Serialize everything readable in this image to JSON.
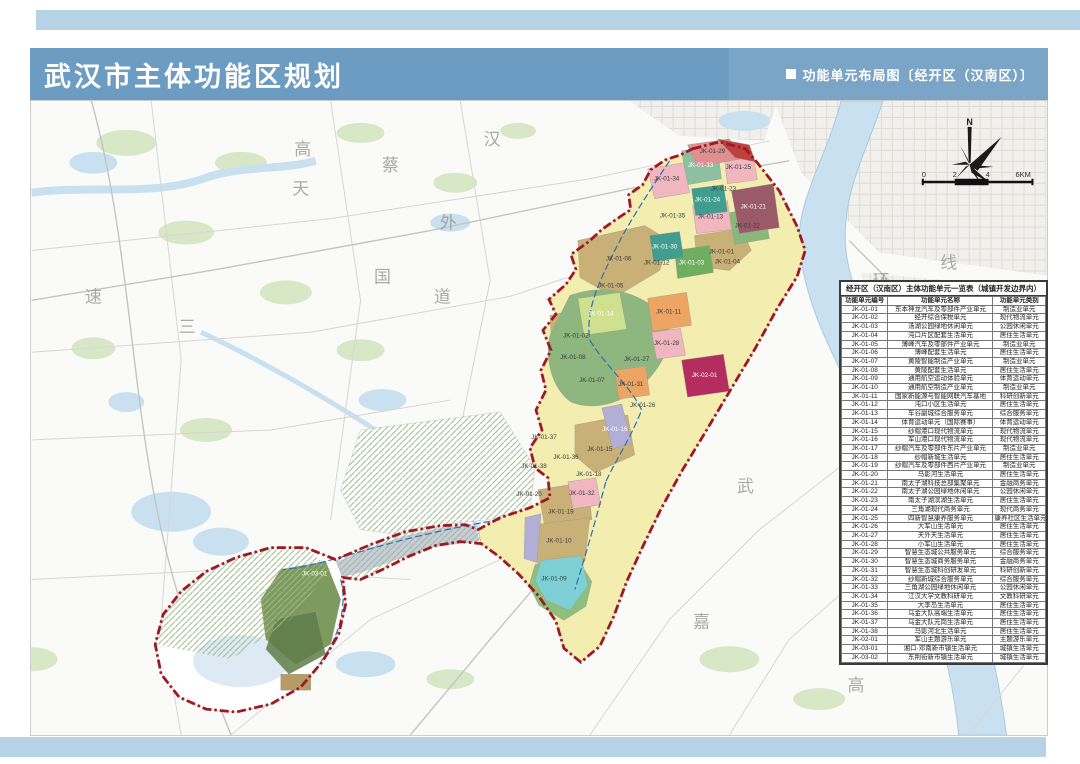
{
  "header": {
    "title": "武汉市主体功能区规划",
    "subtitle_marker": "■",
    "subtitle": "功能单元布局图〔经开区（汉南区）〕"
  },
  "compass": {
    "north_label": "N"
  },
  "scalebar": {
    "labels": [
      "0",
      "2",
      "4",
      "6KM"
    ]
  },
  "table": {
    "title": "经开区（汉南区）主体功能单元一览表（城镇开发边界内）",
    "columns": [
      "功能单元编号",
      "功能单元名称",
      "功能单元类别"
    ],
    "rows": [
      [
        "JK-01-01",
        "东本神龙汽车及零部件产业单元",
        "制造业单元"
      ],
      [
        "JK-01-02",
        "经开综合保税单元",
        "现代物流单元"
      ],
      [
        "JK-01-03",
        "汤湖公园绿地休闲单元",
        "公园休闲单元"
      ],
      [
        "JK-01-04",
        "沌口片区配套生活单元",
        "居住生活单元"
      ],
      [
        "JK-01-05",
        "薄峰汽车及零部件产业单元",
        "制造业单元"
      ],
      [
        "JK-01-06",
        "薄峰配套生活单元",
        "居住生活单元"
      ],
      [
        "JK-01-07",
        "黄陵智能制造产业单元",
        "制造业单元"
      ],
      [
        "JK-01-08",
        "黄陵配套生活单元",
        "居住生活单元"
      ],
      [
        "JK-01-09",
        "通用航空运动体验单元",
        "体育运动单元"
      ],
      [
        "JK-01-10",
        "通用航空制造产业单元",
        "制造业单元"
      ],
      [
        "JK-01-11",
        "国家新能源与智能网联汽车基地",
        "科研创新单元"
      ],
      [
        "JK-01-12",
        "沌口小区生活单元",
        "居住生活单元"
      ],
      [
        "JK-01-13",
        "车谷副城综合服务单元",
        "综合服务单元"
      ],
      [
        "JK-01-14",
        "体育运动单元（国际赛事）",
        "体育运动单元"
      ],
      [
        "JK-01-15",
        "纱帽港口现代物流单元",
        "现代物流单元"
      ],
      [
        "JK-01-16",
        "军山港口现代物流单元",
        "现代物流单元"
      ],
      [
        "JK-01-17",
        "纱帽汽车及零部件东片产业单元",
        "制造业单元"
      ],
      [
        "JK-01-18",
        "纱帽新城生活单元",
        "居住生活单元"
      ],
      [
        "JK-01-19",
        "纱帽汽车及零部件西片产业单元",
        "制造业单元"
      ],
      [
        "JK-01-20",
        "马影河生活单元",
        "居住生活单元"
      ],
      [
        "JK-01-21",
        "南太子湖科技总部集聚单元",
        "金融商务单元"
      ],
      [
        "JK-01-22",
        "南太子湖公园绿地休闲单元",
        "公园休闲单元"
      ],
      [
        "JK-01-23",
        "南太子湖滨湖生活单元",
        "居住生活单元"
      ],
      [
        "JK-01-24",
        "三角湖现代商务单元",
        "现代商务单元"
      ],
      [
        "JK-01-25",
        "四新智慧康养服务单元",
        "康养社区生活单元"
      ],
      [
        "JK-01-26",
        "大军山生活单元",
        "居住生活单元"
      ],
      [
        "JK-01-27",
        "天外天生活单元",
        "居住生活单元"
      ],
      [
        "JK-01-28",
        "小军山生活单元",
        "居住生活单元"
      ],
      [
        "JK-01-29",
        "智慧生态城公共服务单元",
        "综合服务单元"
      ],
      [
        "JK-01-30",
        "智慧生态城商务服务单元",
        "金融商务单元"
      ],
      [
        "JK-01-31",
        "智慧生态城科创研发单元",
        "科研创新单元"
      ],
      [
        "JK-01-32",
        "纱帽新城综合服务单元",
        "综合服务单元"
      ],
      [
        "JK-01-33",
        "三角湖公园绿地休闲单元",
        "公园休闲单元"
      ],
      [
        "JK-01-34",
        "江汉大学文教科研单元",
        "文教科研单元"
      ],
      [
        "JK-01-35",
        "大李岛生活单元",
        "居住生活单元"
      ],
      [
        "JK-01-36",
        "乌金大队高端生活单元",
        "居住生活单元"
      ],
      [
        "JK-01-37",
        "乌金大队元岗生活单元",
        "居住生活单元"
      ],
      [
        "JK-01-38",
        "马影河北生活单元",
        "居住生活单元"
      ],
      [
        "JK-02-01",
        "军山主题游乐单元",
        "主题游乐单元"
      ],
      [
        "JK-03-01",
        "湘口·邓南新市镇生活单元",
        "城镇生活单元"
      ],
      [
        "JK-03-02",
        "东荆街新市镇生活单元",
        "城镇生活单元"
      ]
    ]
  },
  "map": {
    "zone_labels": [
      {
        "id": "JK-01-29",
        "x": 683,
        "y": 52,
        "light": false
      },
      {
        "id": "JK-01-33",
        "x": 671,
        "y": 66,
        "light": true
      },
      {
        "id": "JK-01-25",
        "x": 709,
        "y": 68,
        "light": false
      },
      {
        "id": "JK-01-34",
        "x": 637,
        "y": 80,
        "light": false
      },
      {
        "id": "JK-01-23",
        "x": 694,
        "y": 90,
        "light": false
      },
      {
        "id": "JK-01-24",
        "x": 678,
        "y": 101,
        "light": true
      },
      {
        "id": "JK-01-21",
        "x": 724,
        "y": 108,
        "light": true
      },
      {
        "id": "JK-01-35",
        "x": 643,
        "y": 117,
        "light": false
      },
      {
        "id": "JK-01-13",
        "x": 681,
        "y": 118,
        "light": false
      },
      {
        "id": "JK-01-22",
        "x": 718,
        "y": 127,
        "light": false
      },
      {
        "id": "JK-01-30",
        "x": 635,
        "y": 148,
        "light": true
      },
      {
        "id": "JK-01-01",
        "x": 692,
        "y": 153,
        "light": false
      },
      {
        "id": "JK-01-12",
        "x": 627,
        "y": 164,
        "light": false
      },
      {
        "id": "JK-01-03",
        "x": 662,
        "y": 164,
        "light": true
      },
      {
        "id": "JK-01-04",
        "x": 698,
        "y": 163,
        "light": false
      },
      {
        "id": "JK-01-06",
        "x": 589,
        "y": 160,
        "light": false
      },
      {
        "id": "JK-01-05",
        "x": 581,
        "y": 187,
        "light": false
      },
      {
        "id": "JK-01-14",
        "x": 571,
        "y": 215,
        "light": true
      },
      {
        "id": "JK-01-11",
        "x": 639,
        "y": 213,
        "light": false
      },
      {
        "id": "JK-01-02",
        "x": 546,
        "y": 237,
        "light": false
      },
      {
        "id": "JK-01-28",
        "x": 637,
        "y": 245,
        "light": false
      },
      {
        "id": "JK-01-27",
        "x": 607,
        "y": 261,
        "light": false
      },
      {
        "id": "JK-01-08",
        "x": 543,
        "y": 259,
        "light": false
      },
      {
        "id": "JK-02-01",
        "x": 675,
        "y": 277,
        "light": true
      },
      {
        "id": "JK-01-07",
        "x": 562,
        "y": 282,
        "light": false
      },
      {
        "id": "JK-01-31",
        "x": 601,
        "y": 286,
        "light": false
      },
      {
        "id": "JK-01-26",
        "x": 613,
        "y": 307,
        "light": false
      },
      {
        "id": "JK-01-16",
        "x": 585,
        "y": 331,
        "light": true
      },
      {
        "id": "JK-01-37",
        "x": 514,
        "y": 339,
        "light": false
      },
      {
        "id": "JK-01-15",
        "x": 570,
        "y": 351,
        "light": false
      },
      {
        "id": "JK-01-36",
        "x": 536,
        "y": 359,
        "light": false
      },
      {
        "id": "JK-01-38",
        "x": 504,
        "y": 368,
        "light": false
      },
      {
        "id": "JK-01-18",
        "x": 559,
        "y": 376,
        "light": false
      },
      {
        "id": "JK-01-20",
        "x": 499,
        "y": 396,
        "light": false
      },
      {
        "id": "JK-01-32",
        "x": 552,
        "y": 395,
        "light": false
      },
      {
        "id": "JK-01-19",
        "x": 531,
        "y": 414,
        "light": false
      },
      {
        "id": "JK-01-10",
        "x": 529,
        "y": 443,
        "light": false
      },
      {
        "id": "JK-01-09",
        "x": 524,
        "y": 481,
        "light": false
      },
      {
        "id": "JK-03-01",
        "x": 284,
        "y": 476,
        "light": true
      }
    ],
    "base_labels": [
      {
        "t": "汉",
        "x": 462,
        "y": 44
      },
      {
        "t": "蔡",
        "x": 360,
        "y": 70
      },
      {
        "t": "高",
        "x": 272,
        "y": 54
      },
      {
        "t": "天",
        "x": 270,
        "y": 94
      },
      {
        "t": "外",
        "x": 418,
        "y": 128
      },
      {
        "t": "国",
        "x": 352,
        "y": 182
      },
      {
        "t": "道",
        "x": 412,
        "y": 202
      },
      {
        "t": "速",
        "x": 62,
        "y": 202
      },
      {
        "t": "三",
        "x": 156,
        "y": 232
      },
      {
        "t": "线",
        "x": 920,
        "y": 168
      },
      {
        "t": "环",
        "x": 852,
        "y": 186
      },
      {
        "t": "武",
        "x": 716,
        "y": 392
      },
      {
        "t": "嘉",
        "x": 672,
        "y": 528
      },
      {
        "t": "澳",
        "x": 827,
        "y": 522
      },
      {
        "t": "高",
        "x": 827,
        "y": 592
      }
    ]
  },
  "colors": {
    "header_blue": "#6d9cc3",
    "header_blue_light": "#7ba5c6",
    "strip_blue": "#b5d3e5",
    "boundary_red": "#9e1a22",
    "water_blue": "#c9e0f0",
    "residential_yellow": "#f3eeb0",
    "manufacturing_tan": "#c9b077",
    "park_green": "#7fb46c",
    "service_pink": "#f2b6c0",
    "innovation_orange": "#eda564",
    "theme_crimson": "#b52d5e",
    "logistics_lavender": "#b3aed6",
    "sports_cyan": "#7fd0d6",
    "business_maroon": "#9a5a68",
    "commerce_teal": "#3f9e8f"
  }
}
